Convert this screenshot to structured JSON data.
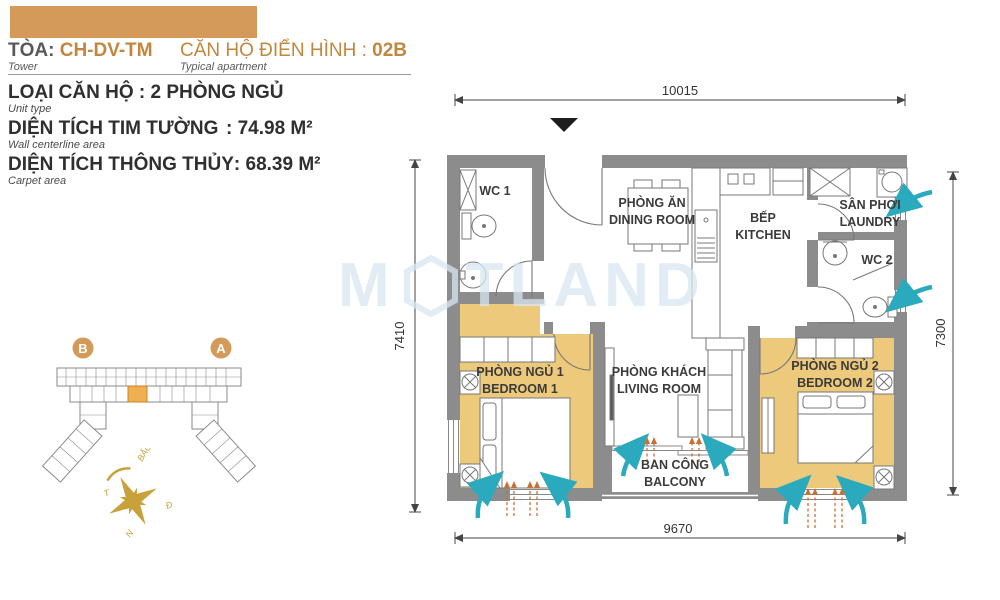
{
  "header": {
    "tower_label": "TÒA:",
    "tower_value": "CH-DV-TM",
    "tower_sub": "Tower",
    "apt_label": "CĂN HỘ ĐIỂN HÌNH :",
    "apt_value": "02B",
    "apt_sub": "Typical apartment"
  },
  "info": {
    "unit_type": "LOẠI CĂN HỘ : 2 PHÒNG NGỦ",
    "unit_type_sub": "Unit type",
    "centerline_label": "DIỆN TÍCH TIM TƯỜNG",
    "centerline_value": ": 74.98 M²",
    "centerline_sub": "Wall centerline area",
    "carpet_label": "DIỆN TÍCH THÔNG THỦY",
    "carpet_value": ": 68.39 M²",
    "carpet_sub": "Carpet area"
  },
  "site_plan": {
    "tower_b": "B",
    "tower_a": "A"
  },
  "compass": {
    "north": "BẮC",
    "west": "T",
    "east": "Đ",
    "south": "N"
  },
  "watermark": {
    "prefix": "M",
    "suffix": "TLAND"
  },
  "plan": {
    "dims": {
      "top": "10015",
      "bottom": "9670",
      "left": "7410",
      "right": "7300"
    },
    "rooms": {
      "wc1": "WC 1",
      "dining_vi": "PHÒNG ĂN",
      "dining_en": "DINING ROOM",
      "kitchen_vi": "BẾP",
      "kitchen_en": "KITCHEN",
      "laundry_vi": "SÂN PHƠI",
      "laundry_en": "LAUNDRY",
      "wc2": "WC 2",
      "bedroom1_vi": "PHÒNG NGỦ 1",
      "bedroom1_en": "BEDROOM 1",
      "living_vi": "PHÒNG KHÁCH",
      "living_en": "LIVING ROOM",
      "bedroom2_vi": "PHÒNG NGỦ 2",
      "bedroom2_en": "BEDROOM 2",
      "balcony_vi": "BAN CÔNG",
      "balcony_en": "BALCONY"
    }
  },
  "colors": {
    "accent_bar": "#D49A5A",
    "brand_text": "#C1873E",
    "room_highlight": "#ECC97B",
    "wall": "#8C8C8C",
    "airflow": "#2BAABD",
    "sun_arrow": "#C87137",
    "compass_gold": "#C9A13B",
    "watermark": "#D9E6F2"
  }
}
